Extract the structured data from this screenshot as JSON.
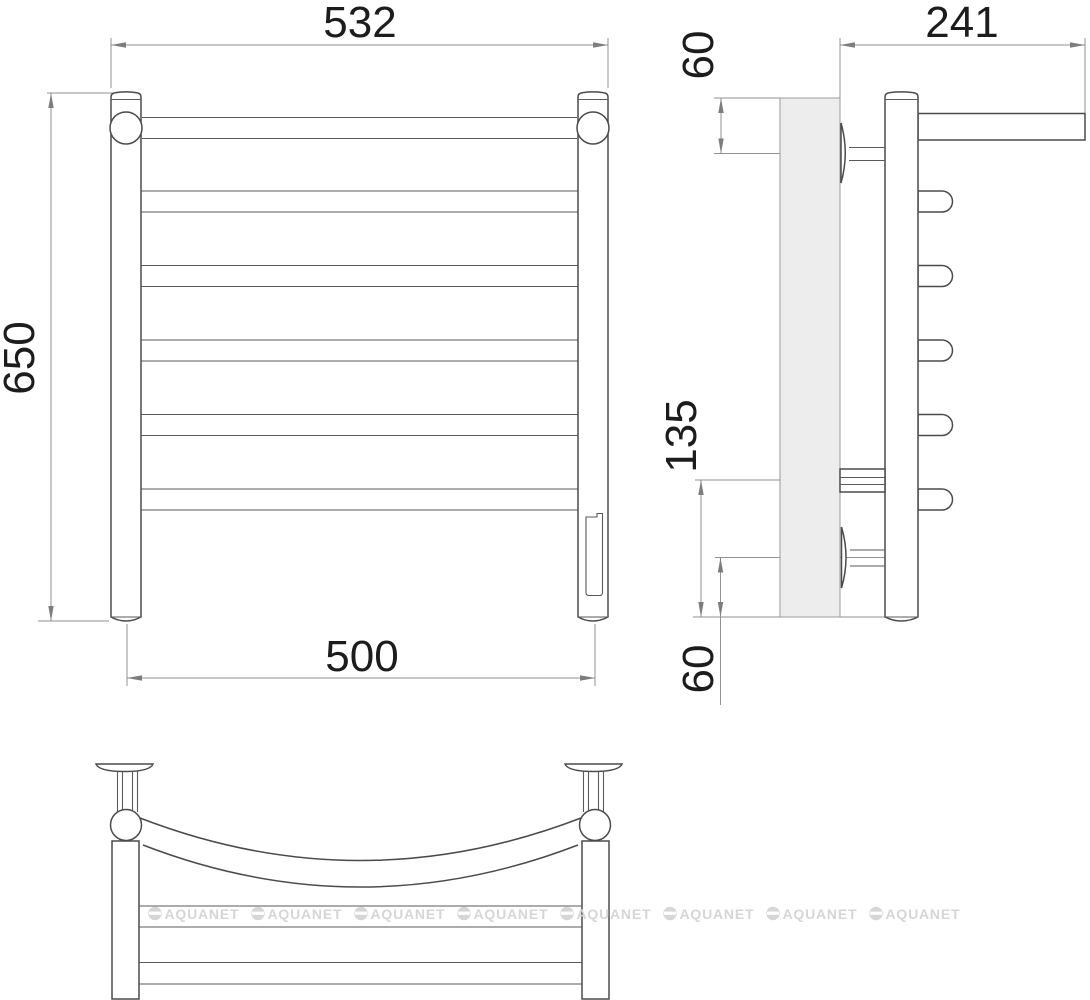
{
  "drawing": {
    "title": "heated-towel-rail-technical-drawing",
    "views": {
      "front": "front-view",
      "side": "side-view",
      "top": "top-view"
    },
    "dimensions": {
      "overall_width": "532",
      "overall_height": "650",
      "axle_distance": "500",
      "depth": "241",
      "top_bracket_offset": "60",
      "lower_bracket_spacing": "135",
      "bottom_bracket_offset": "60"
    },
    "watermark": {
      "brand": "AQUANET",
      "count": 8
    },
    "colors": {
      "background": "#ffffff",
      "object_line": "#4b4b4b",
      "dimension_line": "#929292",
      "dimension_text": "#1c1c1c",
      "wall_fill": "#ededed",
      "watermark": "#d6d6d6"
    }
  }
}
